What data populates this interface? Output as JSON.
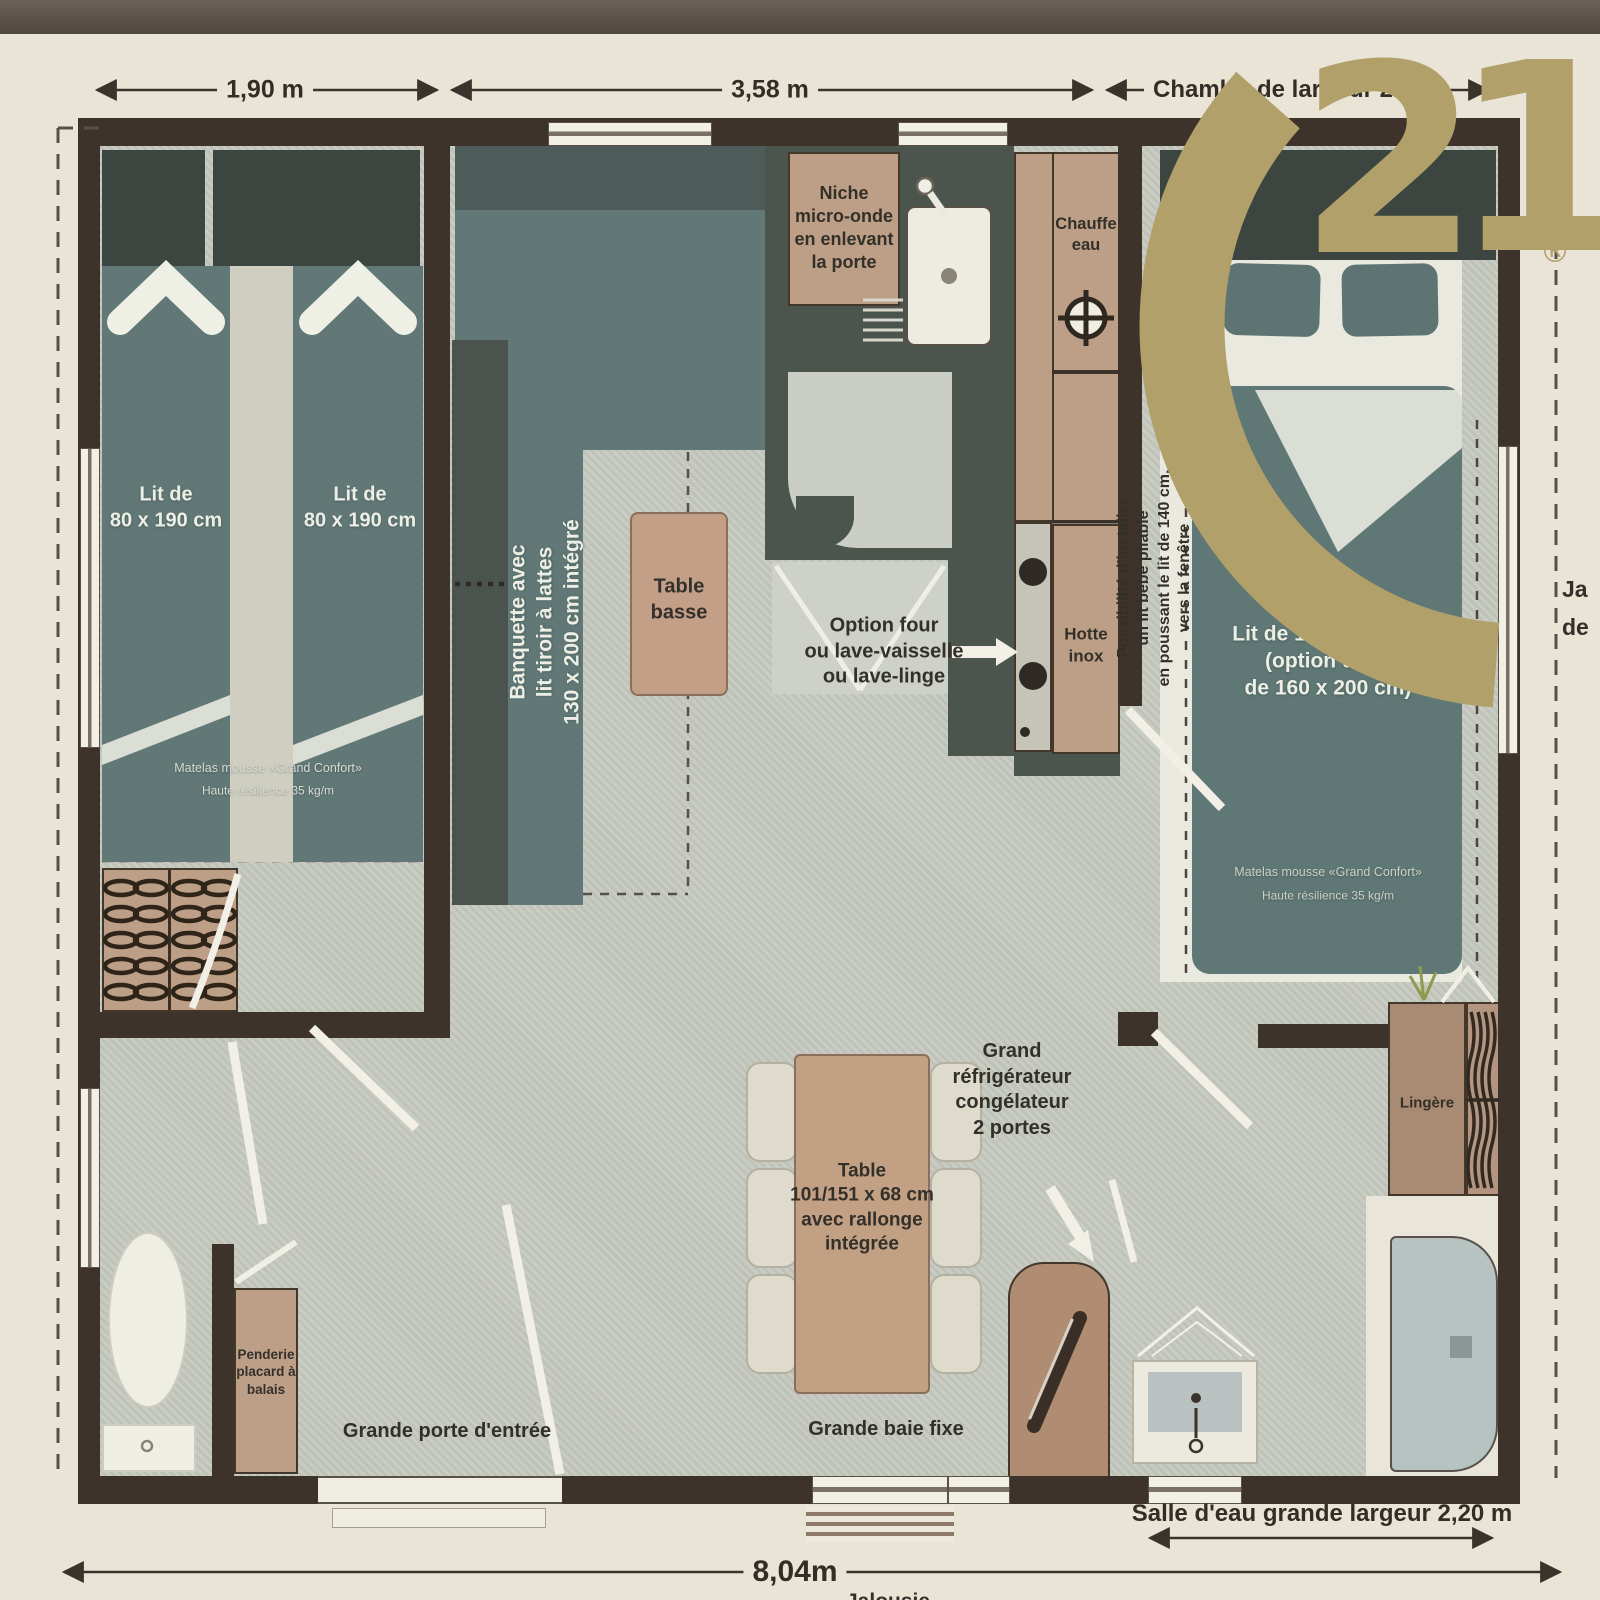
{
  "brand": {
    "numeral_2": "2",
    "numeral_1": "1",
    "registered": "®",
    "gold_color": "#b1a069"
  },
  "dims": {
    "top_left": "1,90 m",
    "top_mid": "3,58 m",
    "top_right_a": "Chambre",
    "top_right_b": "de largeur 2",
    "bottom_room": "Salle d'eau grande largeur 2,20 m",
    "bottom_total": "8,04m",
    "bottom_partial": "Jalousie",
    "edge_partial_a": "Ja",
    "edge_partial_b": "de"
  },
  "left_bedroom": {
    "bed_left": "Lit de\n80 x 190 cm",
    "bed_right": "Lit de\n80 x 190 cm",
    "mattress_1": "Matelas mousse «Grand Confort»",
    "mattress_2": "Haute résilience 35 kg/m"
  },
  "living": {
    "banquette": "Banquette avec\nlit tiroir à lattes\n130 x 200 cm intégré",
    "coffee_table": "Table\nbasse",
    "dining_table": "Table\n101/151 x 68 cm\navec rallonge\nintégrée",
    "bay": "Grande baie fixe",
    "entrance": "Grande porte d'entrée",
    "fridge": "Grand\nréfrigérateur\ncongélateur\n2 portes"
  },
  "kitchen": {
    "microwave": "Niche\nmicro-onde\nen enlevant\nla porte",
    "water_heater": "Chauffe\neau",
    "hood": "Hotte\ninox",
    "appliance_option": "Option four\nou lave-vaisselle\nou lave-linge"
  },
  "right_bedroom": {
    "bed": "Lit de 140 x 190 cm\n(option de lit\nde 160 x 200 cm)",
    "mattress_1": "Matelas mousse «Grand Confort»",
    "mattress_2": "Haute résilience 35 kg/m",
    "baby_note": "Possibilité d'installer\nun lit bébé pliable\nen poussant le lit de 140 cm,\nvers la fenêtre"
  },
  "bathroom": {
    "linen": "Lingère",
    "closet": "Penderie\nplacard à\nbalais"
  },
  "colors": {
    "wall": "#3e332a",
    "floor": "#c6c9bf",
    "bed_teal": "#617877",
    "furniture_tan": "#bd9e87",
    "logo_gold": "#b1a069"
  }
}
